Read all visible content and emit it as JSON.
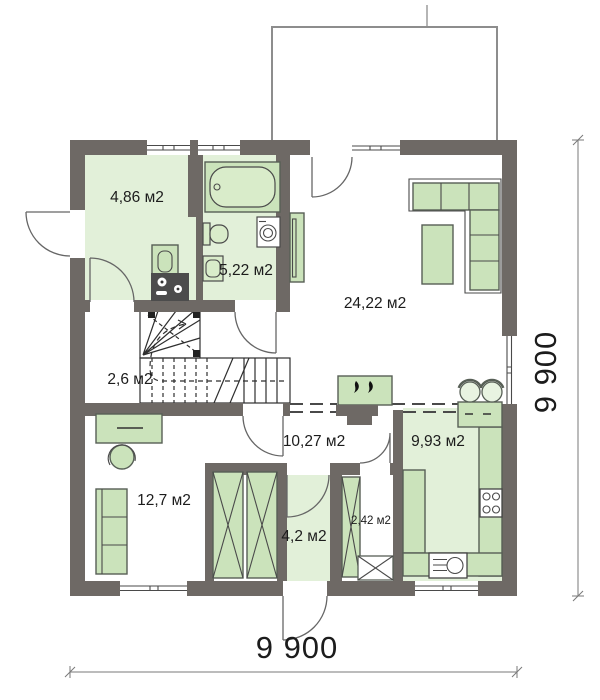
{
  "rooms": {
    "hallway": "4,86 м2",
    "bathroom": "5,22 м2",
    "living": "24,22 м2",
    "stair_hall": "2,6 м2",
    "corridor": "10,27 м2",
    "kitchen": "9,93 м2",
    "bedroom": "12,7 м2",
    "vestibule": "4,2 м2",
    "closet": "2,42 м2"
  },
  "dimensions": {
    "width": "9 900",
    "height": "9 900"
  },
  "colors": {
    "wall": "#6e6965",
    "room_fill": "#e2f0d9",
    "furniture_fill": "#cbe3bb",
    "fixture_fill": "#d9ecca",
    "appliance_dark": "#4c4c4c",
    "line": "#4a4a4a"
  }
}
